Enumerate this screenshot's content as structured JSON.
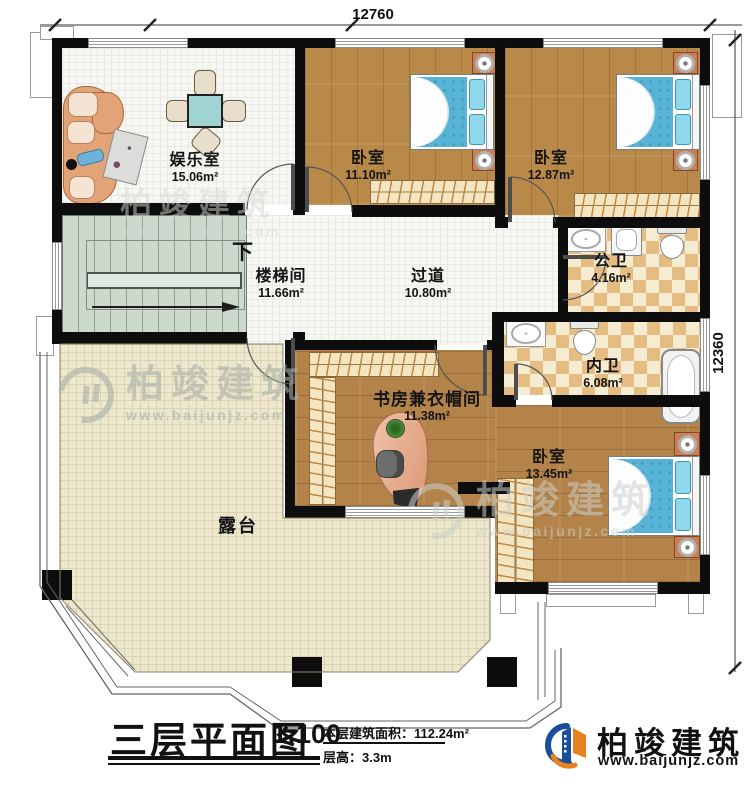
{
  "dimensions": {
    "top": "12760",
    "right": "12360"
  },
  "stairs": {
    "down_label": "下"
  },
  "rooms": {
    "entertainment": {
      "name": "娱乐室",
      "area": "15.06m²"
    },
    "bedroom1": {
      "name": "卧室",
      "area": "11.10m²"
    },
    "bedroom2": {
      "name": "卧室",
      "area": "12.87m²"
    },
    "public_bath": {
      "name": "公卫",
      "area": "4.16m²"
    },
    "stairwell": {
      "name": "楼梯间",
      "area": "11.66m²"
    },
    "hallway": {
      "name": "过道",
      "area": "10.80m²"
    },
    "ensuite_bath": {
      "name": "内卫",
      "area": "6.08m²"
    },
    "study_cloakroom": {
      "name": "书房兼衣帽间",
      "area": "11.38m²"
    },
    "bedroom3": {
      "name": "卧室",
      "area": "13.45m²"
    },
    "terrace": {
      "name": "露台"
    }
  },
  "title_block": {
    "title": "三层平面图",
    "scale": "1:100",
    "floor_area": "本层建筑面积：112.24m²",
    "floor_height": "层高：3.3m"
  },
  "logo": {
    "company": "柏竣建筑",
    "website": "www.baijunjz.com"
  },
  "watermark": {
    "company": "柏竣建筑",
    "website": "www.baijunjz.com"
  },
  "colors": {
    "brand_blue": "#1b4f9c",
    "brand_orange": "#e8821e",
    "wood": "#b9894a",
    "tile": "#e5bd82",
    "terrace": "#ece7cd",
    "stairs": "#cdd9cd",
    "bed_blue": "#58b4d6",
    "wall": "#0d0d0d"
  }
}
